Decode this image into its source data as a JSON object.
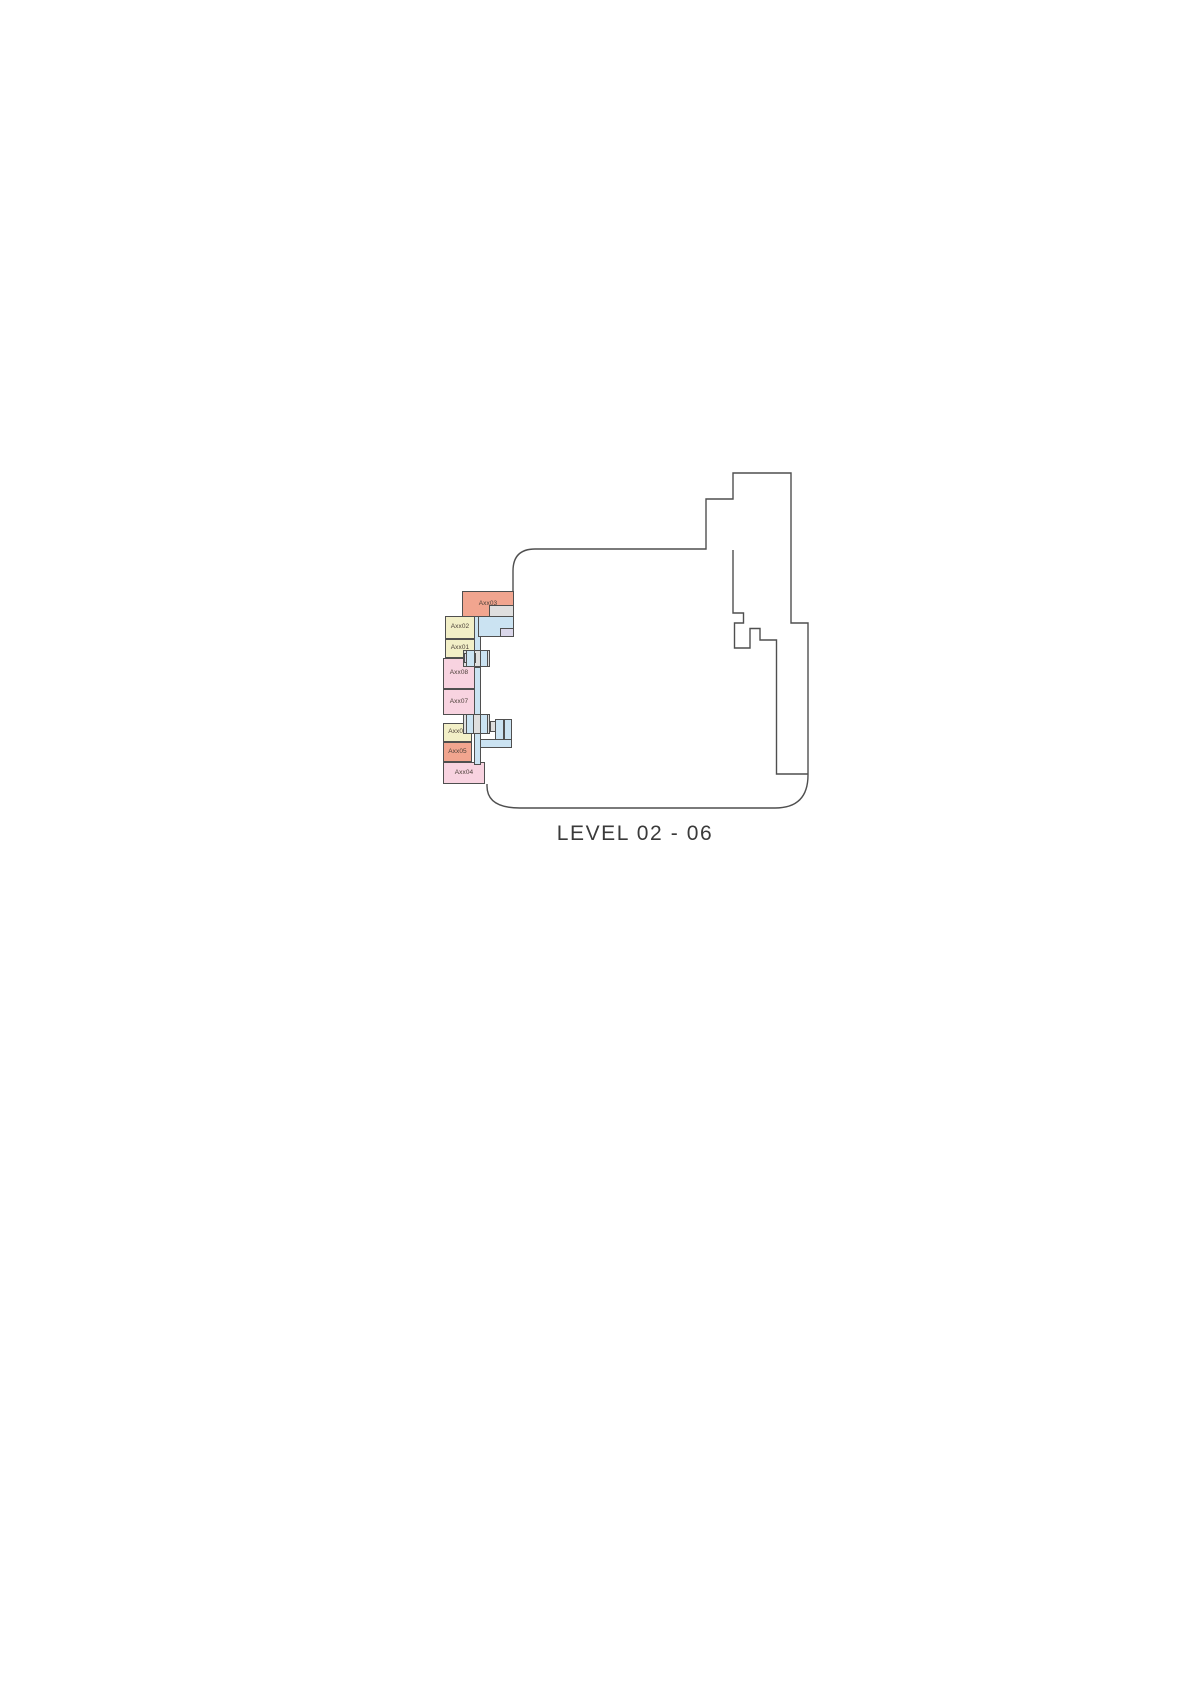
{
  "plan": {
    "title": "LEVEL 02 - 06",
    "outline_color": "#4f4f4f",
    "title_color": "#3a3a3a",
    "label_color": "#4a3f38",
    "rooms": [
      {
        "label": "Axx03",
        "fill": "#f1a58f"
      },
      {
        "label": "Axx02",
        "fill": "#f2efc7"
      },
      {
        "label": "Axx01",
        "fill": "#f2efc7"
      },
      {
        "label": "Axx08",
        "fill": "#f8d3e0"
      },
      {
        "label": "Axx07",
        "fill": "#f8d3e0"
      },
      {
        "label": "Axx06",
        "fill": "#f2efc7"
      },
      {
        "label": "Axx05",
        "fill": "#f1a58f"
      },
      {
        "label": "Axx04",
        "fill": "#f8d3e0"
      }
    ],
    "core_colors": {
      "circulation_blue": "#cbe3f2",
      "stair_gray": "#dfdfdf",
      "shaft_lavender": "#dad7ea"
    }
  }
}
